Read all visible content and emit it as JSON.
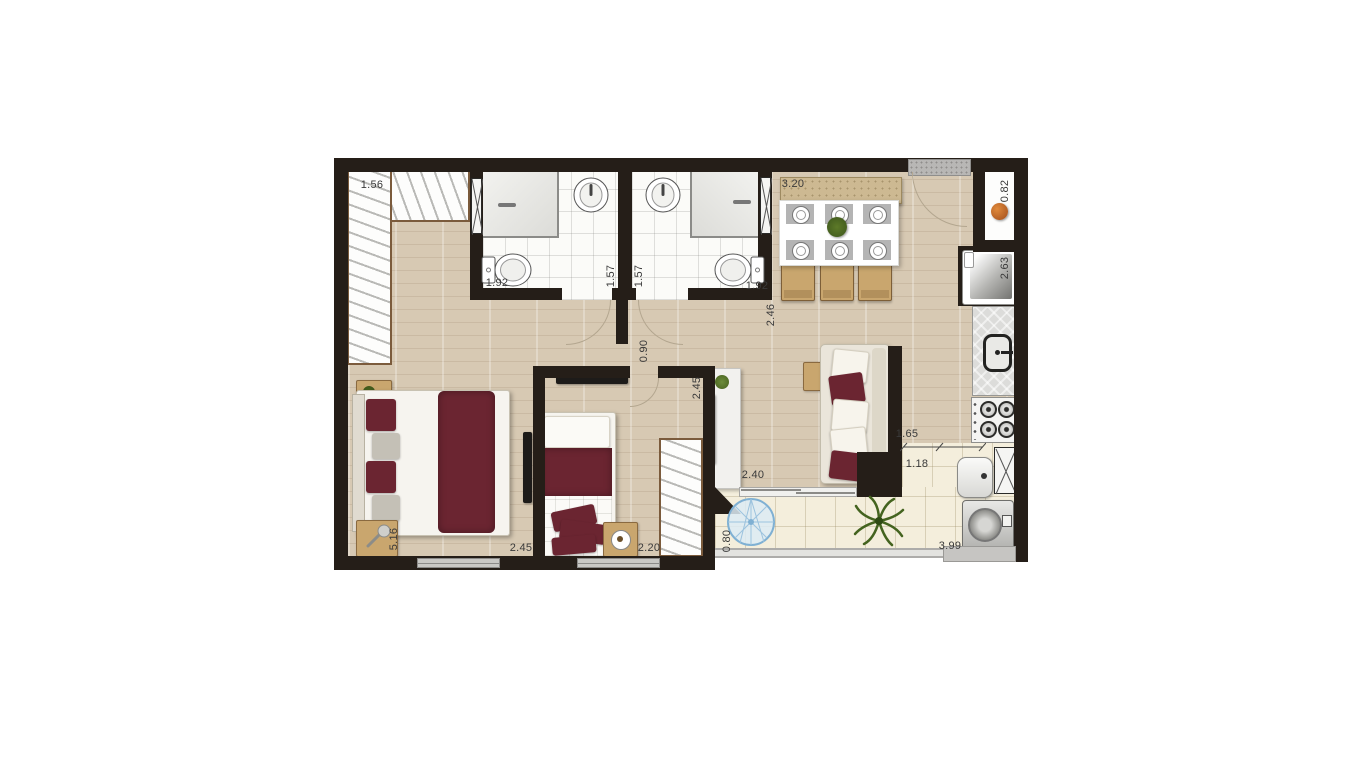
{
  "plan": {
    "type": "apartment-floor-plan",
    "dimensions": {
      "closet_width": "1.56",
      "bath1_length": "1.92",
      "bath1_width": "1.57",
      "bath2_width": "1.57",
      "bath2_length": "1.92",
      "dining_width": "3.20",
      "niche_width": "0.82",
      "kitchen_length": "2.63",
      "hall_depth": "2.46",
      "corridor_width": "0.90",
      "living_width": "2.45",
      "living_opening": "2.40",
      "kitchen_passage": "1.65",
      "service_width": "1.18",
      "master_length": "5.16",
      "master_width": "2.45",
      "bedroom2_width": "2.20",
      "balcony_depth": "0.80",
      "balcony_length": "3.99"
    },
    "colors": {
      "wall": "#251e18",
      "wood_floor": "#d7c9b3",
      "bath_tile": "#fbfbf8",
      "balcony_tile": "#f4eedc",
      "accent_maroon": "#6b2531",
      "furniture_tan": "#c9a66e",
      "water_blue": "#7fb0d3",
      "plant_green": "#44631f",
      "label_text": "#3a3a3a"
    }
  }
}
